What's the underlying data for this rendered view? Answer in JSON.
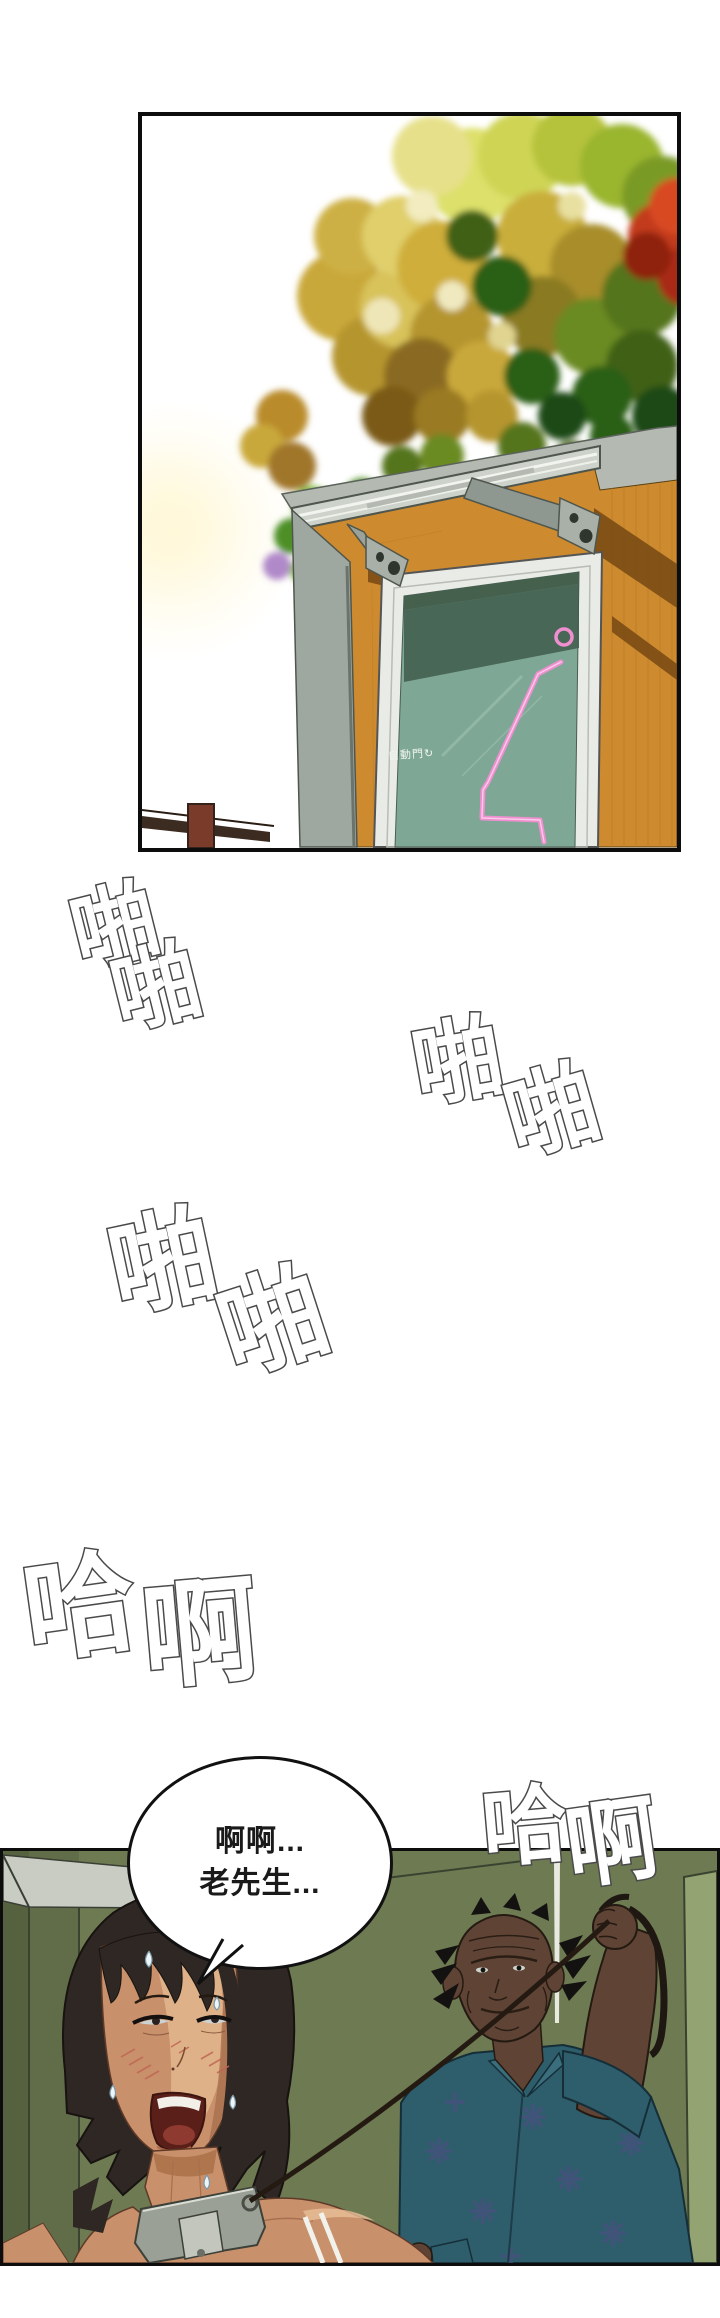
{
  "page": {
    "width": 720,
    "height": 2318,
    "background": "#ffffff"
  },
  "panel1": {
    "description": "low-angle exterior view of a shop entrance: autumn trees above, gray awning, orange wood wall, teal glass automatic door with pink neon sign",
    "door_sign": {
      "text": "自動門",
      "icon": "rotate-arrow-icon",
      "icon_glyph": "↻",
      "color": "#f2f5f0"
    },
    "palette": {
      "tree_gold": "#c9a83a",
      "tree_yellow_green": "#d8d65e",
      "tree_orange": "#b87a22",
      "tree_green": "#4e8f26",
      "tree_dark_green": "#2c5e18",
      "tree_red": "#c23a1a",
      "tree_purple": "#b089c9",
      "wood_wall": "#cd8a2f",
      "wall_shadow": "#6f4310",
      "awning": "#cdd2cb",
      "fascia": "#b4bab2",
      "door_frame": "#e9ebe7",
      "door_glass": "#7ea795",
      "glass_shadow": "#3f5c4b",
      "neon_pink": "#ef8fd0",
      "railing_post": "#7a3b2a"
    }
  },
  "sfx": {
    "fill": "#ffffff",
    "outline": "#4a4a4a",
    "items": [
      {
        "text": "啪"
      },
      {
        "text": "啪"
      },
      {
        "text": "啪"
      },
      {
        "text": "啪"
      },
      {
        "text": "啪"
      },
      {
        "text": "啪"
      },
      {
        "text": "哈"
      },
      {
        "text": "啊"
      },
      {
        "text": "哈"
      },
      {
        "text": "啊"
      }
    ]
  },
  "speech_bubble": {
    "lines": [
      "啊啊...",
      "老先生..."
    ],
    "fill": "#ffffff",
    "border": "#111111",
    "text_color": "#1a1a1a"
  },
  "panel2": {
    "description": "interior: flushed woman wearing a gray collar on a leash held up by an old man in a teal floral shirt, olive green walls",
    "palette": {
      "wall": "#6d7a52",
      "wall_dark": "#55613f",
      "ceiling": "#c9ccc3",
      "door_light": "#93a371",
      "woman_skin": "#c8906b",
      "woman_hair": "#2e2723",
      "man_skin": "#5f4436",
      "shirt": "#2e5e6c",
      "shirt_pattern": "#47517e",
      "collar": "#9aa096",
      "leash": "#241a12"
    }
  }
}
